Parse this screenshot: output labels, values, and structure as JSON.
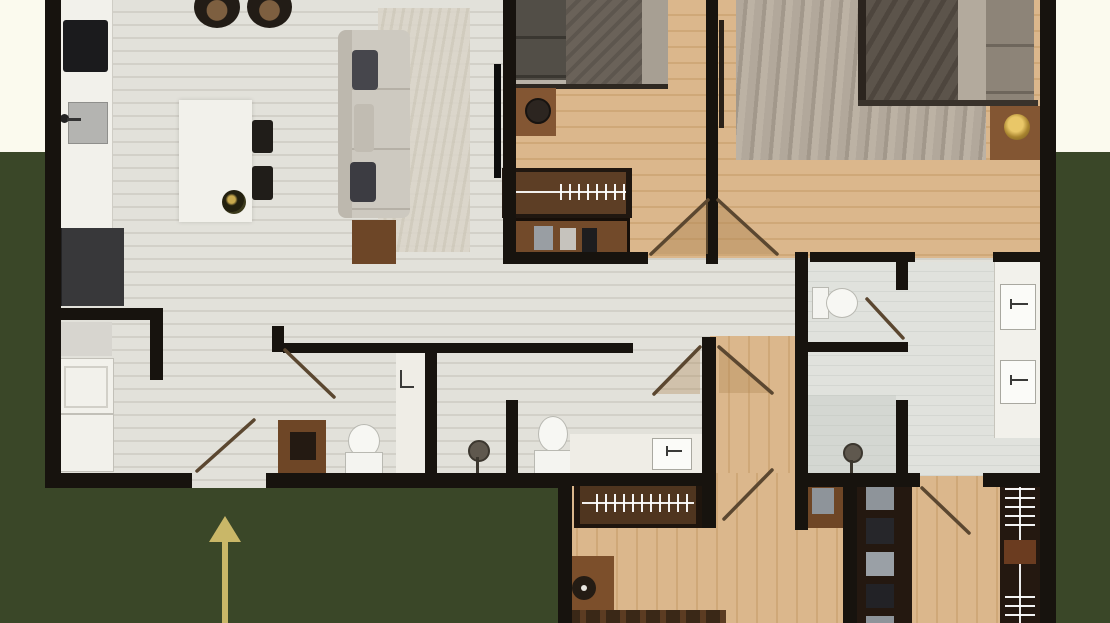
{
  "meta": {
    "content_type": "3d-rendered-apartment-floor-plan",
    "visible_text": "none",
    "orientation_marker": "gold entry arrow pointing up toward the main entrance opening"
  },
  "canvas": {
    "width": 1110,
    "height": 623
  },
  "colors": {
    "background_top": "#fbfaee",
    "background_green": "#3a4728",
    "wall": "#17130e",
    "light_floor": "#e2e1da",
    "light_floor_streak": "#d2d0c8",
    "wood_floor": "#dbb78c",
    "wood_floor_streak": "#cfa878",
    "tile_floor": "#e0e2dd",
    "furniture_white": "#f2f1eb",
    "furniture_wood": "#835633",
    "furniture_dark": "#241a11",
    "arrow_gold": "#c9b768",
    "door_line": "#5b4730"
  },
  "rooms": [
    {
      "name": "kitchen",
      "contents": [
        "counter",
        "cooktop",
        "sink",
        "fridge",
        "bar-stools"
      ]
    },
    {
      "name": "dining-area",
      "contents": [
        "table",
        "two-chairs",
        "plant"
      ]
    },
    {
      "name": "living-room",
      "contents": [
        "sofa",
        "rug",
        "side-table",
        "tv"
      ]
    },
    {
      "name": "laundry-room",
      "contents": [
        "shelf",
        "washer",
        "dryer"
      ]
    },
    {
      "name": "entry-hall",
      "contents": [
        "entry-door-swing",
        "gold-direction-arrow"
      ]
    },
    {
      "name": "bathroom-1",
      "contents": [
        "wood-vanity",
        "toilet",
        "white-vanity-sink",
        "door-swing"
      ]
    },
    {
      "name": "bathroom-2",
      "contents": [
        "shower-column",
        "toilet",
        "counter-sink",
        "door-swing"
      ]
    },
    {
      "name": "corridor",
      "contents": []
    },
    {
      "name": "bedroom-1",
      "contents": [
        "bed",
        "nightstand-lamp",
        "wardrobe-hangers",
        "desk-chairs",
        "door-swing"
      ]
    },
    {
      "name": "master-bedroom",
      "contents": [
        "bed",
        "rug",
        "nightstand",
        "gold-lamp",
        "open-door-leaf",
        "door-swing"
      ]
    },
    {
      "name": "wc",
      "contents": [
        "toilet",
        "door-swing"
      ]
    },
    {
      "name": "master-bathroom",
      "contents": [
        "double-sink-vanity",
        "shower",
        "door-to-closet"
      ]
    },
    {
      "name": "inner-hallway",
      "contents": [
        "double-door-swings"
      ]
    },
    {
      "name": "bedroom-2",
      "contents": [
        "closet-hangers",
        "cabinet",
        "nightstand",
        "bed-partial",
        "door-swing"
      ]
    },
    {
      "name": "walk-in-closet",
      "contents": [
        "shelf-wardrobe",
        "hanger-wardrobe",
        "door-swing"
      ]
    }
  ]
}
